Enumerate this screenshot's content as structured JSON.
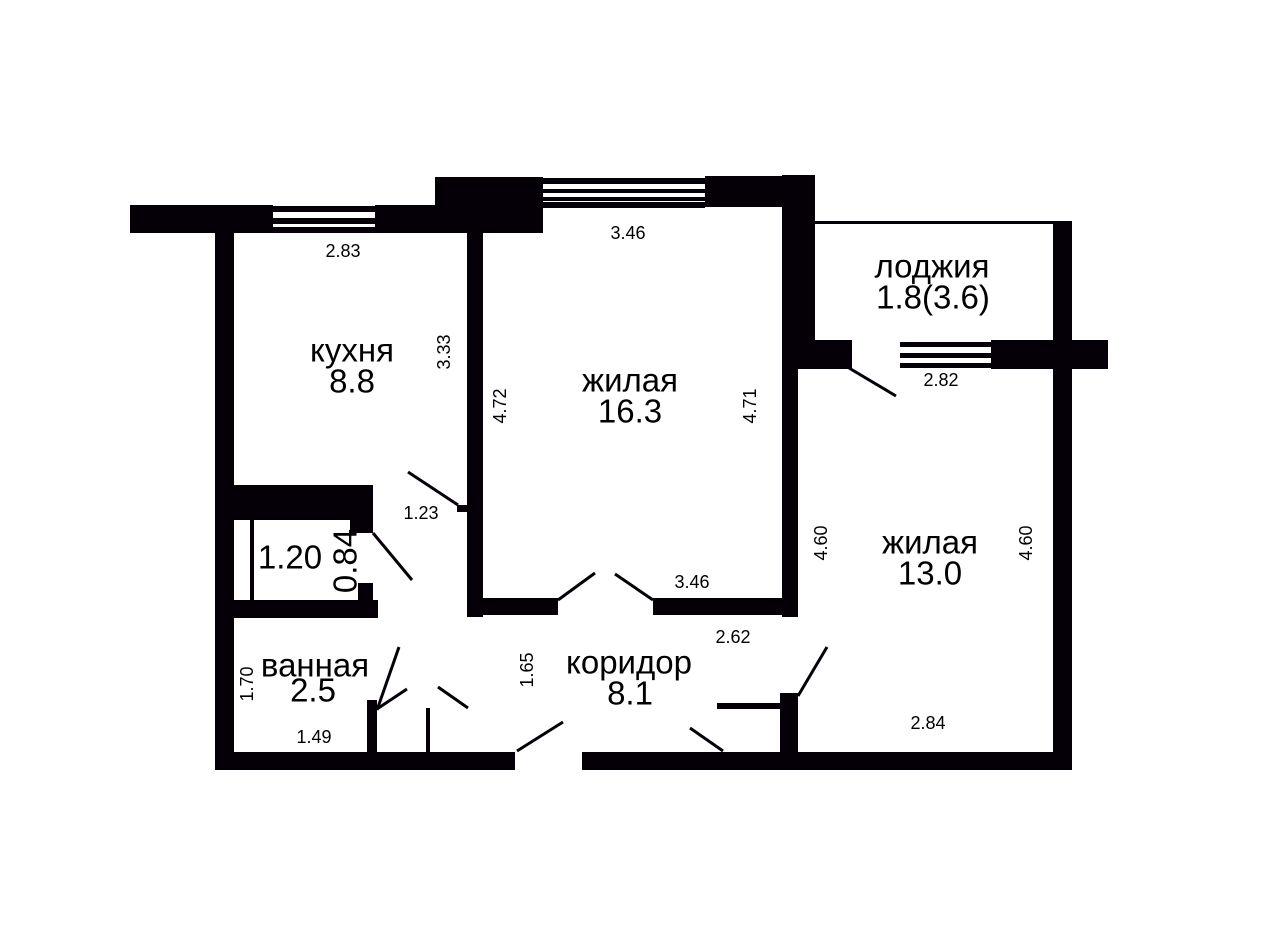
{
  "rooms": {
    "kitchen": {
      "name": "кухня",
      "area": "8.8"
    },
    "living_large": {
      "name": "жилая",
      "area": "16.3"
    },
    "living_small": {
      "name": "жилая",
      "area": "13.0"
    },
    "loggia": {
      "name": "лоджия",
      "area": "1.8(3.6)"
    },
    "bathroom": {
      "name": "ванная",
      "area": "2.5"
    },
    "corridor": {
      "name": "коридор",
      "area": "8.1"
    }
  },
  "dims": {
    "kitchen_top": "2.83",
    "kitchen_right": "3.33",
    "living1_top": "3.46",
    "living1_left": "4.72",
    "living1_right": "4.71",
    "living1_bottom": "3.46",
    "loggia_bottom": "2.82",
    "living2_left": "4.60",
    "living2_right": "4.60",
    "living2_bottom": "2.84",
    "vestibule_width": "1.23",
    "closet_width": "1.20",
    "closet_depth": "0.84",
    "bathroom_left": "1.70",
    "bathroom_bottom": "1.49",
    "corridor_left": "1.65",
    "corridor_right": "2.62"
  },
  "colors": {
    "wall": "#050008",
    "background": "#ffffff",
    "text": "#000000"
  }
}
